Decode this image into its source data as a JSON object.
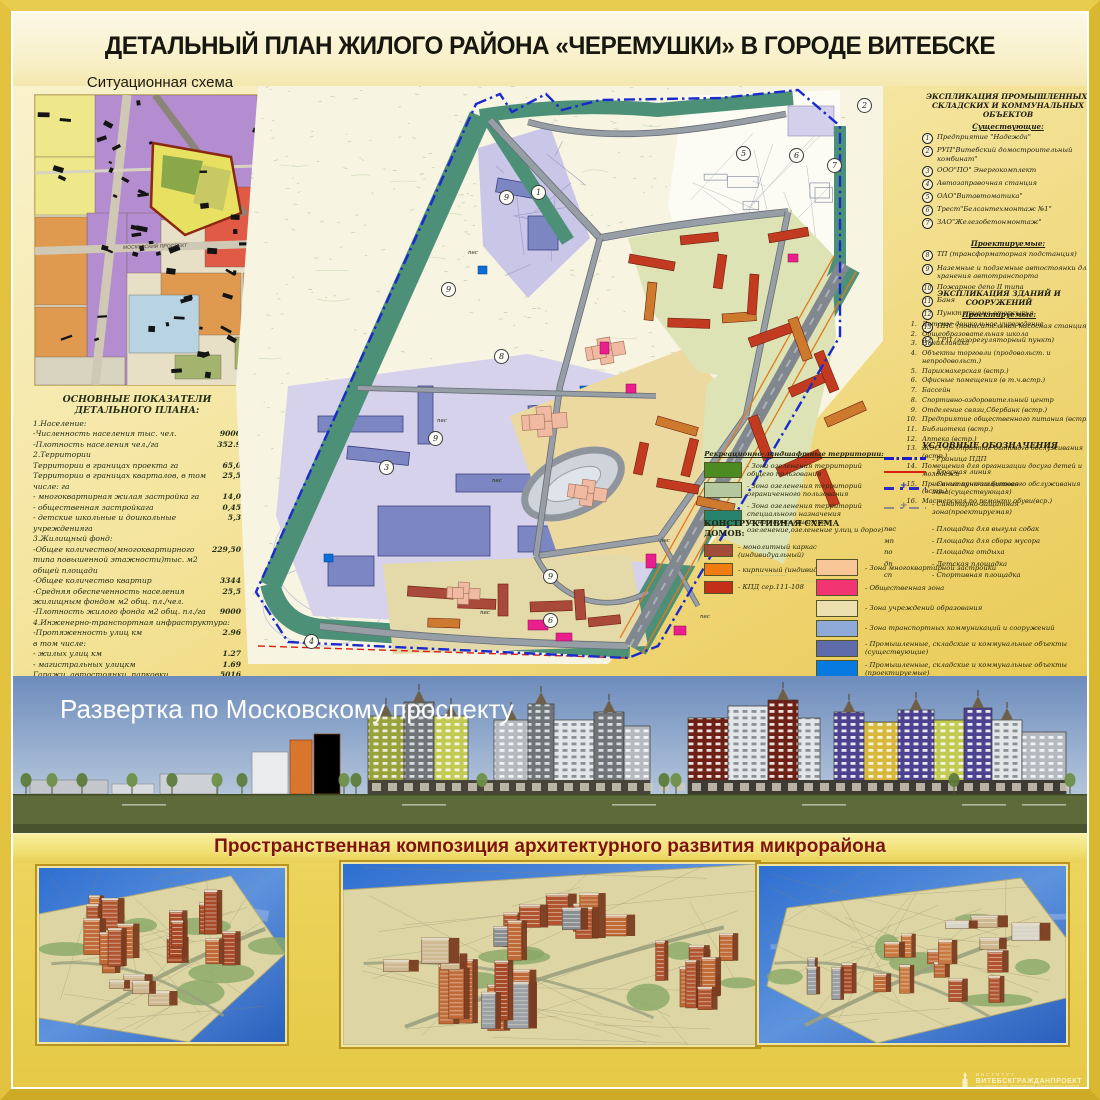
{
  "poster": {
    "title": "ДЕТАЛЬНЫЙ ПЛАН ЖИЛОГО РАЙОНА «ЧЕРЕМУШКИ» В ГОРОДЕ ВИТЕБСКЕ",
    "watermark_small": "ИНСТИТУТ",
    "watermark_big": "ВИТЕБСКГРАЖДАНПРОЕКТ",
    "watermark_caption": "узел архитектурных, планировочных, конструкторских решений"
  },
  "situational": {
    "title": "Ситуационная схема",
    "road_label": "МОСКОВСКИЙ ПРОСПЕКТ"
  },
  "functional_legend": {
    "title": "Функциональное использование территории",
    "subtitle": "Территории в границах детального плана:",
    "items": [
      {
        "label": "-Жилая многоквартирная",
        "color": "#f2a05a"
      },
      {
        "label": "-Общественная",
        "color": "#e63a20"
      },
      {
        "label": "-Школьных и дошкольных учреждений",
        "color": "#f6f055"
      },
      {
        "label": "-Ландшафтно-рекреационная",
        "color": "#7fb478"
      },
      {
        "label": "-Промышленно-административная",
        "color": "#9084cb"
      },
      {
        "label": "-Открытых ландшафтов",
        "color": "#6d7b3e"
      }
    ],
    "line_items": [
      {
        "label": "-Граница детального плана",
        "style": "red-dashed"
      },
      {
        "label": "-Граница СЭЗ",
        "style": "red-dashdot"
      }
    ]
  },
  "indicators": {
    "title": "ОСНОВНЫЕ ПОКАЗАТЕЛИ ДЕТАЛЬНОГО ПЛАНА:",
    "rows": [
      {
        "label": "1.Население:",
        "value": ""
      },
      {
        "label": "-Численность населения  тыс. чел.",
        "value": "9000"
      },
      {
        "label": "-Плотность населения  чел./га",
        "value": "352.9"
      },
      {
        "label": "2.Территории",
        "value": ""
      },
      {
        "label": "Территории в границах проекта  га",
        "value": "65,0"
      },
      {
        "label": "Территории в границах кварталов, в том числе:  га",
        "value": "25,5"
      },
      {
        "label": "- многоквартирная жилая застройка га",
        "value": "14,0"
      },
      {
        "label": "- общественная застройкага",
        "value": "0,45"
      },
      {
        "label": "- детские школьные и дошкольные учрежденияга",
        "value": "5,3"
      },
      {
        "label": "3.Жилищный фонд:",
        "value": ""
      },
      {
        "label": "-Общее количество(многоквартирного типа повышенной этажности)тыс. м2 общей площади",
        "value": "229,50"
      },
      {
        "label": "-Общее количество квартир",
        "value": "3344"
      },
      {
        "label": "-Средняя обеспеченность населения жилищным фондом м2 общ. пл./чел.",
        "value": "25,5"
      },
      {
        "label": "-Плотность жилого фонда м2 общ. пл./га",
        "value": "9000"
      },
      {
        "label": "4.Инженерно-транспортная инфраструктура:",
        "value": ""
      },
      {
        "label": "-Протяженность улиц  км",
        "value": "2.96"
      },
      {
        "label": "в том числе:",
        "value": ""
      },
      {
        "label": "- жилых улиц  км",
        "value": "1.27"
      },
      {
        "label": "- магистральных улицкм",
        "value": "1.69"
      },
      {
        "label": "Гаражи, автостоянки, парковки",
        "value": "5016"
      },
      {
        "label": "в том числе:",
        "value": ""
      },
      {
        "label": "- парковки маш./мест",
        "value": "836"
      },
      {
        "label": "- постоянного хранения маш./мест",
        "value": ""
      },
      {
        "label": "(подземно-наземные паркинги)",
        "value": "4180"
      }
    ]
  },
  "industrial_explication": {
    "title_1": "ЭКСПЛИКАЦИЯ ПРОМЫШЛЕННЫХ,",
    "title_2": "СКЛАДСКИХ  И КОММУНАЛЬНЫХ ОБЪЕКТОВ",
    "existing_header": "Существующие:",
    "existing": [
      {
        "n": "1",
        "label": "Предприятие \"Надежда\""
      },
      {
        "n": "2",
        "label": "РУП\"Витебский домостроительный комбинат\""
      },
      {
        "n": "3",
        "label": "ООО\"ПО\" Энергокомплект"
      },
      {
        "n": "4",
        "label": "Автозаправочная станция"
      },
      {
        "n": "5",
        "label": "ОАО\"Витавтоматика\""
      },
      {
        "n": "6",
        "label": "Трест\"Белсантехмонтаж №1\""
      },
      {
        "n": "7",
        "label": "ЗАО\"Железобетонмонтаж\""
      }
    ],
    "planned_header": "Проектируемые:",
    "planned": [
      {
        "n": "8",
        "label": "ТП (трансформаторная подстанция)"
      },
      {
        "n": "9",
        "label": "Наземные и подземные автостоянки для хранения автотранспорта"
      },
      {
        "n": "10",
        "label": "Пожарное депо  II  типа"
      },
      {
        "n": "11",
        "label": "Баня"
      },
      {
        "n": "12",
        "label": "Пункт приема вторсырья"
      },
      {
        "n": "13",
        "label": "ПНС (повысительная насосная станция)"
      },
      {
        "n": "14",
        "label": "ГРП (газорегуляторный пункт)"
      }
    ]
  },
  "buildings_explication": {
    "title": "ЭКСПЛИКАЦИЯ  ЗДАНИЙ И СООРУЖЕНИЙ",
    "header": "Проектируемые:",
    "items": [
      {
        "n": "1.",
        "label": "Детское дошкольное учреждение"
      },
      {
        "n": "2.",
        "label": "Общеобразовательная школа"
      },
      {
        "n": "3.",
        "label": "Поликлиника"
      },
      {
        "n": "4.",
        "label": "Объекты торговли (продовольст. и непродовольст.)"
      },
      {
        "n": "5.",
        "label": "Парикмахерская (встр.)"
      },
      {
        "n": "6.",
        "label": "Офисные помещения (в т.ч.встр.)"
      },
      {
        "n": "7.",
        "label": "Бассейн"
      },
      {
        "n": "8.",
        "label": "Спортивно-оздоровительный центр"
      },
      {
        "n": "9.",
        "label": "Отделение связи,Сбербанк (встр.)"
      },
      {
        "n": "10.",
        "label": "Предприятие общественного питания (встр.)"
      },
      {
        "n": "11.",
        "label": "Библиотека (встр.)"
      },
      {
        "n": "12.",
        "label": "Аптека (встр.)"
      },
      {
        "n": "13.",
        "label": "ЖЭС; предприятие бытового обслуживания (встр.)"
      },
      {
        "n": "14.",
        "label": "Помещения для организации досуга детей и молодежи"
      },
      {
        "n": "15.",
        "label": "Приемные пункты бытового обслуживания (встр.)"
      },
      {
        "n": "16.",
        "label": "Мастерская по ремонту обуви(вср.)"
      }
    ]
  },
  "symbols_legend": {
    "title": "УСЛОВНЫЕ ОБОЗНАЧЕНИЯ",
    "line_items": [
      {
        "label": "- Граница ПДП",
        "style": "blue-dashdot"
      },
      {
        "label": "- Красная линия",
        "style": "red-line"
      },
      {
        "label": "- Санитарно-защитная зона(существующая)",
        "style": "blue-dashplus"
      },
      {
        "label": "- Санитарно-защитная зона(проектируемая)",
        "style": "gray-dashplus"
      }
    ],
    "abbr_items": [
      {
        "abbr": "пвс",
        "label": "- Площадка для выгула собак"
      },
      {
        "abbr": "мп",
        "label": "- Площадка для сбора мусора"
      },
      {
        "abbr": "по",
        "label": "- Площадка отдыха"
      },
      {
        "abbr": "дп",
        "label": "- Детская площадка"
      },
      {
        "abbr": "сп",
        "label": "- Спортивная площадка"
      }
    ]
  },
  "recreation_legend": {
    "title": "Рекреационно-ландшафтные территории:",
    "items": [
      {
        "label": "- Зона озеленения территорий общего пользования",
        "color": "#4c8b22"
      },
      {
        "label": "- Зона озеленения территорий ограниченного пользования",
        "color": "#b5c79e"
      },
      {
        "label": "- Зона озеленения территорий специального назначения (санитарно-защитное озеленение,озеленение улиц и дорог)",
        "color": "#27836e"
      }
    ]
  },
  "construction_legend": {
    "title": "КОНСТРУКТИВНАЯ СХЕМА ДОМОВ:",
    "items": [
      {
        "label": "- монолитный каркас (индивидуальный)",
        "color": "#a34a38"
      },
      {
        "label": "- кирпичный (индивидуальный)",
        "color": "#f07c12"
      },
      {
        "label": "- КПД сер.111-108",
        "color": "#c52f17"
      }
    ]
  },
  "zones_legend": {
    "items": [
      {
        "label": "- Зона многоквартирной застройки",
        "color": "#f9c697"
      },
      {
        "label": "- Общественная зона",
        "color": "#f23572"
      },
      {
        "label": "- Зона учреждений образования",
        "color": "#ecdfb0"
      },
      {
        "label": "- Зона транспортных коммуникаций и сооружений",
        "color": "#8fa9d9"
      },
      {
        "label": "- Промышленные, складские и коммунальные объекты (существующие)",
        "color": "#5e6cab"
      },
      {
        "label": "- Промышленные, складские и коммунальные объекты (проектируемые)",
        "color": "#077ae1"
      },
      {
        "label": "-Территории промышленных, складских и коммунальных объектов (существующие)",
        "color": "#d9c089"
      }
    ]
  },
  "map": {
    "badges": [
      "2",
      "5",
      "6",
      "7",
      "1",
      "9",
      "9",
      "9",
      "3",
      "8",
      "9",
      "6",
      "4"
    ],
    "area_label": "пвс"
  },
  "elevation": {
    "title": "Развертка по Московскому проспекту"
  },
  "composition": {
    "title": "Пространственная композиция архитектурного развития микрорайона"
  }
}
